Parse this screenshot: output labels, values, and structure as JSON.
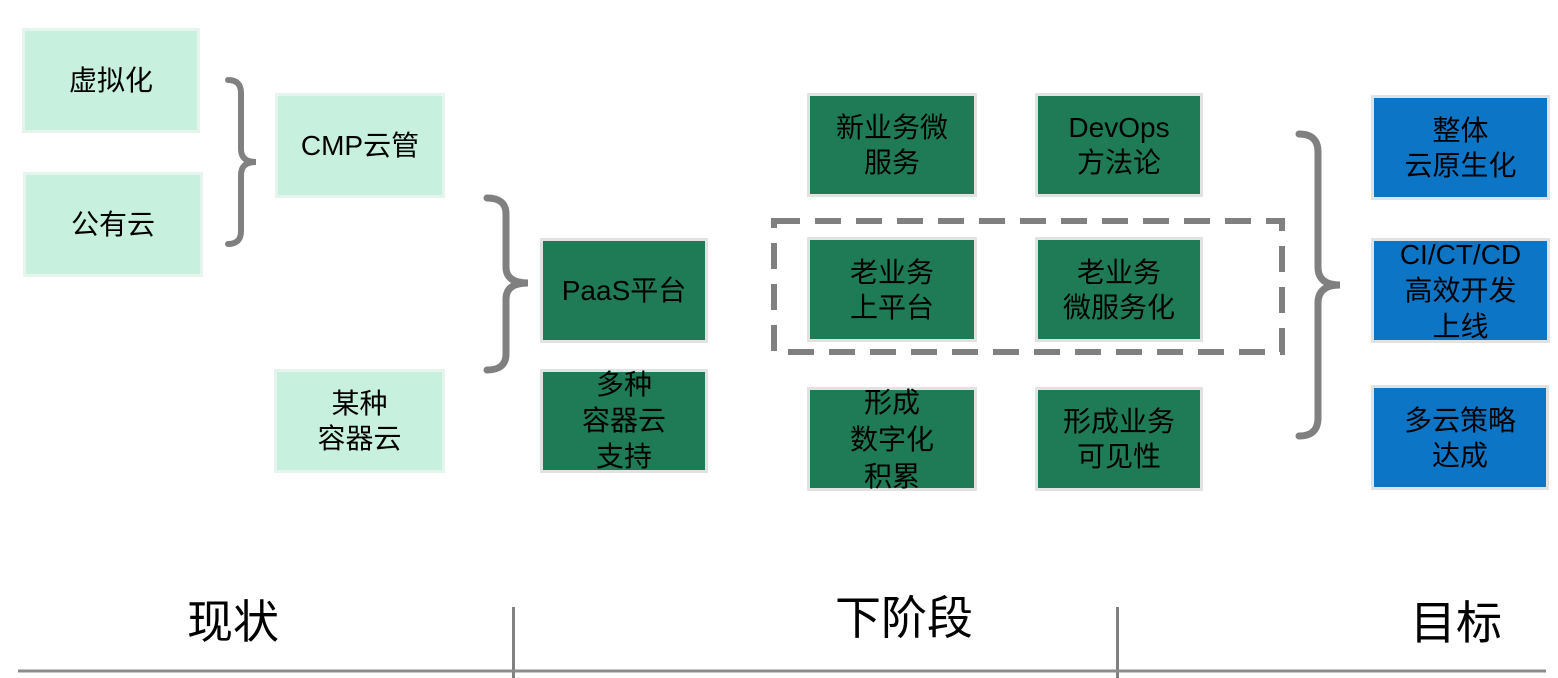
{
  "colors": {
    "mint_box": "#C8F0DE",
    "green_box": "#1E7B55",
    "blue_box": "#0D75C5",
    "connector_gray": "#808080",
    "text": "#000000"
  },
  "stages": {
    "current": {
      "label": "现状",
      "boxes": {
        "virtualization": "虚拟化",
        "public_cloud": "公有云",
        "cmp_cloud_mgmt": "CMP云管",
        "some_container_cloud": "某种\n容器云"
      }
    },
    "next": {
      "label": "下阶段",
      "boxes": {
        "paas_platform": "PaaS平台",
        "multi_container_support": "多种\n容器云\n支持",
        "new_biz_microservices": "新业务微\n服务",
        "devops_methodology": "DevOps\n方法论",
        "legacy_on_platform": "老业务\n上平台",
        "legacy_microservices": "老业务\n微服务化",
        "digital_accumulation": "形成\n数字化\n积累",
        "business_visibility": "形成业务\n可见性"
      }
    },
    "goal": {
      "label": "目标",
      "boxes": {
        "overall_cloud_native": "整体\n云原生化",
        "ci_ct_cd_delivery": "CI/CT/CD\n高效开发\n上线",
        "multi_cloud_strategy": "多云策略\n达成"
      }
    }
  }
}
